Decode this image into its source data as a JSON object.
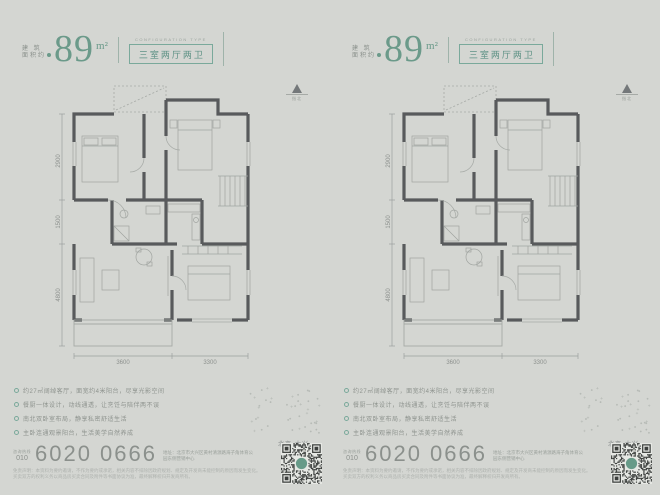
{
  "colors": {
    "background": "#d4d6d2",
    "accent_green": "#6b9a8a",
    "wall_gray": "#585a5c",
    "phone_gray": "#8b908c"
  },
  "floorplan": {
    "dims_left": [
      "2900",
      "1500",
      "4800"
    ],
    "dims_bottom": [
      "3600",
      "3300"
    ]
  },
  "panels": [
    {
      "area": {
        "label_line1": "建 筑",
        "label_line2": "面积约",
        "value": "89",
        "unit": "m²"
      },
      "type": {
        "caption_en": "CONFIGURATION TYPE",
        "name_cn": "三室两厅两卫"
      },
      "north_label": "指北",
      "features": [
        "约27㎡阔绰客厅，面宽约4米阳台，尽享光影空间",
        "餐厨一体设计，动线通透，让烹饪与陪伴两不误",
        "南北双卧室布局，静享私密舒适生活",
        "主卧连通观景阳台，生活美学自然养成"
      ],
      "brand_mark": "北京·大兴",
      "contact": {
        "hotline_label": "咨询热线",
        "area_code": "010",
        "phone": "6020 0666",
        "address": "地址：北京市大兴区黄村清源路海子角体育公园东侧营销中心"
      },
      "disclaimer": [
        "免责声明：本资料为要约邀请，不作为要约或承诺，相关内容不排除因政府规划、规定及开发商未能控制的原因而发生变化。",
        "买卖双方的权利义务以商品房买卖合同及附件等书面协议为准，最终解释权归开发商所有。"
      ]
    },
    {
      "area": {
        "label_line1": "建 筑",
        "label_line2": "面积约",
        "value": "89",
        "unit": "m²"
      },
      "type": {
        "caption_en": "CONFIGURATION TYPE",
        "name_cn": "三室两厅两卫"
      },
      "north_label": "指北",
      "features": [
        "约27㎡阔绰客厅，面宽约4米阳台，尽享光影空间",
        "餐厨一体设计，动线通透，让烹饪与陪伴两不误",
        "南北双卧室布局，静享私密舒适生活",
        "主卧连通观景阳台，生活美学自然养成"
      ],
      "brand_mark": "北京·大兴",
      "contact": {
        "hotline_label": "咨询热线",
        "area_code": "010",
        "phone": "6020 0666",
        "address": "地址：北京市大兴区黄村清源路海子角体育公园东侧营销中心"
      },
      "disclaimer": [
        "免责声明：本资料为要约邀请，不作为要约或承诺，相关内容不排除因政府规划、规定及开发商未能控制的原因而发生变化。",
        "买卖双方的权利义务以商品房买卖合同及附件等书面协议为准，最终解释权归开发商所有。"
      ]
    }
  ]
}
